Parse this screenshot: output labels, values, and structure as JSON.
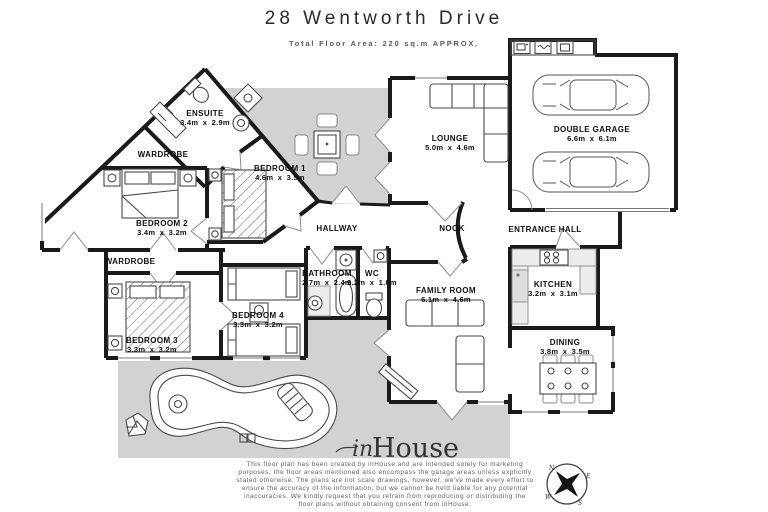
{
  "header": {
    "title": "28 Wentworth Drive",
    "subtitle": "Total Floor Area: 220 sq.m APPROX."
  },
  "rooms": {
    "ensuite": {
      "name": "ENSUITE",
      "dims": "3.4m x 2.9m"
    },
    "wardrobe1": {
      "name": "WARDROBE"
    },
    "bedroom1": {
      "name": "BEDROOM 1",
      "dims": "4.6m x 3.5m"
    },
    "bedroom2": {
      "name": "BEDROOM 2",
      "dims": "3.4m x 3.2m"
    },
    "wardrobe2": {
      "name": "WARDROBE"
    },
    "bedroom3": {
      "name": "BEDROOM 3",
      "dims": "3.3m x 3.2m"
    },
    "bedroom4": {
      "name": "BEDROOM 4",
      "dims": "3.3m x 3.2m"
    },
    "hallway": {
      "name": "HALLWAY"
    },
    "bathroom": {
      "name": "BATHROOM",
      "dims": "2.7m x 2.4m"
    },
    "wc": {
      "name": "WC",
      "dims": "2.2m x 1.0m"
    },
    "lounge": {
      "name": "LOUNGE",
      "dims": "5.0m x 4.6m"
    },
    "nook": {
      "name": "NOOK"
    },
    "entrance_hall": {
      "name": "ENTRANCE HALL"
    },
    "kitchen": {
      "name": "KITCHEN",
      "dims": "3.2m x 3.1m"
    },
    "dining": {
      "name": "DINING",
      "dims": "3.8m x 3.5m"
    },
    "family_room": {
      "name": "FAMILY ROOM",
      "dims": "6.1m x 4.6m"
    },
    "double_garage": {
      "name": "DOUBLE GARAGE",
      "dims": "6.6m x 6.1m"
    }
  },
  "branding": {
    "logo_in": "in",
    "logo_house": "House"
  },
  "compass": {
    "n": "N",
    "e": "E",
    "s": "S",
    "w": "W"
  },
  "disclaimer": {
    "lines": [
      "This floor plan has been created by inHouse and are intended solely for marketing",
      "purposes, the floor areas mentioned also encompass the garage areas unless explicitly",
      "stated otherwise. The plans are not scale drawings, however, we've made every effort to",
      "ensure the accuracy of the information, but we cannot be held liable for any potential",
      "inaccuracies. We kindly request that you refrain from reproducing or distributing the",
      "floor plans without obtaining consent from inHouse."
    ]
  },
  "colors": {
    "outdoor_gray": "#d2d2d2",
    "wall_black": "#1a1a1a"
  }
}
